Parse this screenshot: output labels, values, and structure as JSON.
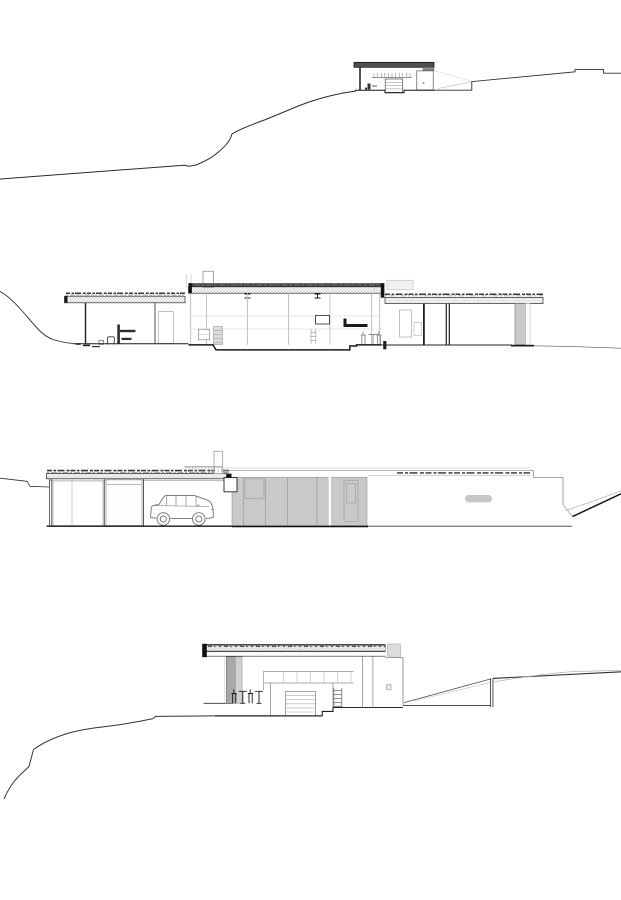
{
  "sheet": {
    "width": 621,
    "height": 900,
    "background": "#ffffff",
    "drawing_count": 4
  },
  "colors": {
    "paper": "#ffffff",
    "ink": "#1f1f1f",
    "line_light": "#b5b5b5",
    "ghost_gray": "#dcdcdc",
    "panel_gray": "#c9c9c9",
    "pillar_gray": "#c9c9c9",
    "column_dark": "#a8a8a8",
    "column_light": "#d0d0d0",
    "roof_dark": "#4f4f4f",
    "roof_band_dark": "#454545",
    "pill_gray": "#c6c6c6"
  },
  "drawings": [
    {
      "id": "site-section-overview",
      "type": "architectural-site-section",
      "position": "top",
      "features": [
        "hillside-terrain-line",
        "small-pavilion-section",
        "flat-dark-roof",
        "roller-door",
        "upper-terrace-steps"
      ]
    },
    {
      "id": "longitudinal-section",
      "type": "architectural-section",
      "position": "upper-middle",
      "features": [
        "green-roof-texture",
        "clerestory-glazing",
        "fireplace-chimney",
        "sunken-floor",
        "bathroom-fixtures",
        "stools-and-table",
        "roof-pillar"
      ]
    },
    {
      "id": "entry-elevation",
      "type": "architectural-elevation",
      "position": "lower-middle",
      "features": [
        "carport-with-suv",
        "green-roof-texture",
        "gray-panel-wall",
        "roof-railing",
        "chimney",
        "letterbox-slot",
        "sloping-ground"
      ]
    },
    {
      "id": "cross-section",
      "type": "architectural-section",
      "position": "bottom",
      "features": [
        "hillside-terrain-line",
        "hatched-roof-slab",
        "gray-column",
        "garage-door",
        "table-and-chairs",
        "retaining-post"
      ]
    }
  ]
}
